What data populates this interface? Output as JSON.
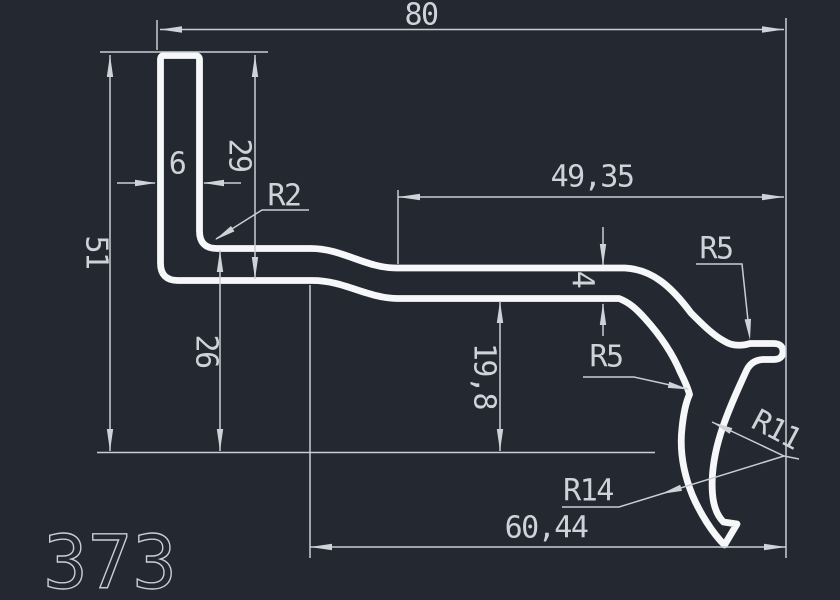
{
  "drawing": {
    "part_number": "373",
    "colors": {
      "background": "#232831",
      "profile_line": "#f6f7f8",
      "dimension_line": "#c9ced5"
    },
    "dims": {
      "overall_width": "80",
      "overall_height": "51",
      "flange_thickness": "6",
      "flange_depth": "29",
      "corner_radius": "R2",
      "top_right_length": "49,35",
      "web_thickness": "4",
      "mid_drop": "19,8",
      "left_drop": "26",
      "fillet_left": "R5",
      "fillet_right": "R5",
      "radius_small": "R11",
      "radius_large": "R14",
      "bottom_width": "60,44"
    }
  }
}
